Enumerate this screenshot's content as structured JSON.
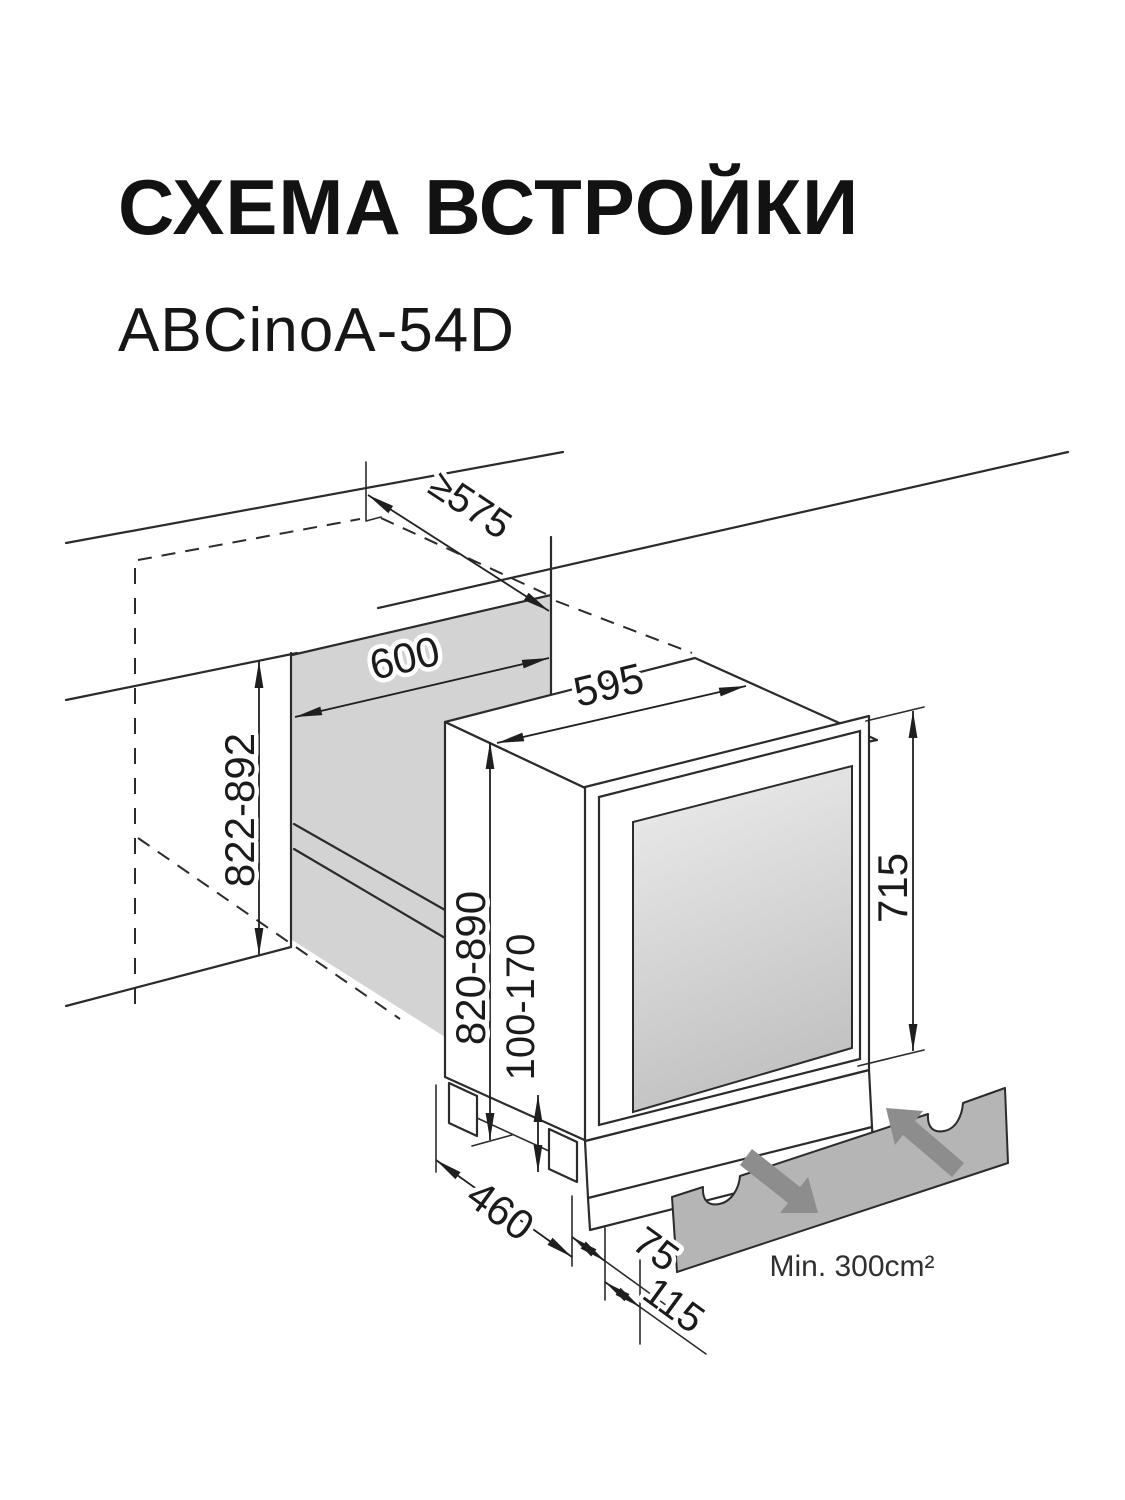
{
  "page": {
    "title": "СХЕМА ВСТРОЙКИ",
    "model": "ABCinoA-54D"
  },
  "diagram": {
    "dims": {
      "niche_depth": "≥575",
      "niche_width": "600",
      "appliance_width": "595",
      "niche_height": "822-892",
      "appliance_height": "820-890",
      "plinth_height": "100-170",
      "door_height": "715",
      "base_depth": "460",
      "door_offset": "75",
      "plinth_offset": "115",
      "vent_area": "Min. 300cm²"
    },
    "colors": {
      "line": "#2b2b2b",
      "niche_wall": "#d3d3d3",
      "glass_light": "#ededed",
      "glass_dark": "#c2c2c2",
      "vent_panel": "#b5b5b5",
      "airflow_arrow": "#8d8d8d"
    }
  }
}
